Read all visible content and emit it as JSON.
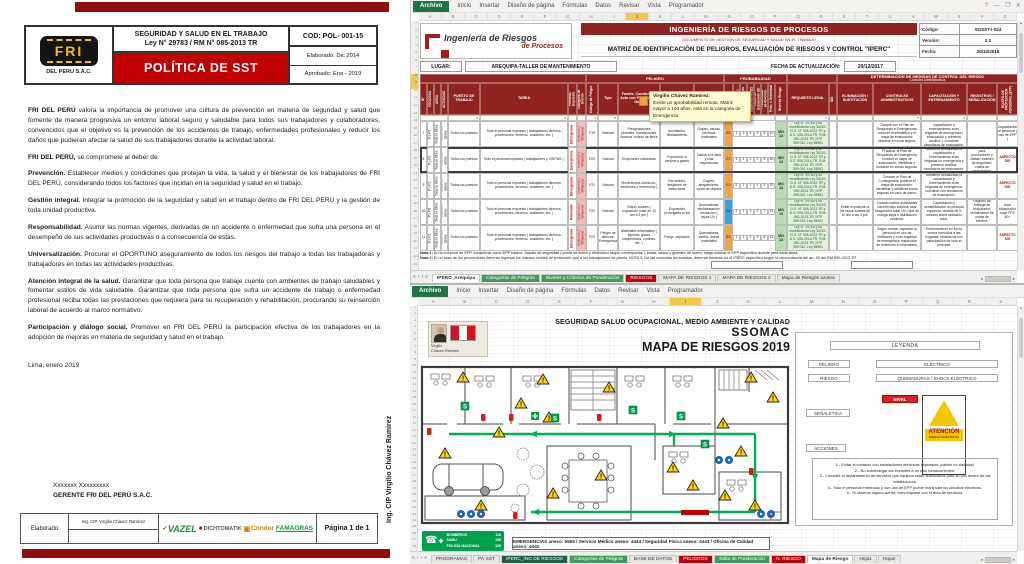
{
  "ui": {
    "ribbon_tabs": [
      "Inicio",
      "Insertar",
      "Diseño de página",
      "Fórmulas",
      "Datos",
      "Revisar",
      "Vista",
      "Programador"
    ],
    "file_tab": "Archivo",
    "win": {
      "help": "?",
      "min": "—",
      "max": "❐",
      "close": "✕"
    },
    "filter_icon": "▾",
    "tabnav": [
      "«",
      "‹",
      "›",
      "»"
    ],
    "scroll_left": "◂",
    "scroll_right": "▸",
    "scroll_up": "▴",
    "scroll_down": "▾"
  },
  "document": {
    "logo": {
      "brand": "FRI",
      "sub": "DEL PERU S.A.C."
    },
    "header": {
      "title_line1": "SEGURIDAD Y SALUD EN EL TRABAJO",
      "title_line2": "Ley N° 29783 / RM N° 085-2013 TR",
      "code": "COD: POL- 001-15",
      "policy_title": "POLÍTICA DE SST",
      "elaborated": "Elaborado:  Dic 2014",
      "approved": "Aprobado: Ene - 2019"
    },
    "paragraphs": [
      {
        "lead": "FRI DEL PERÚ",
        "text": " valora  la importancia de promover una cultura de prevención  en materia de seguridad y salud que fomente de manera progresiva un entorno  laboral seguro y saludable para todos sus trabajadores y colaboradores, convencidos que el objetivo es  la prevención de los accidentes de trabajo, enfermedades profesionales y reducir los daños  que  pudieran afectar  la salud de sus trabajadores durante  la actividad laboral."
      },
      {
        "lead": "FRI DEL PERÚ,",
        "text": " se compromete al deber de:"
      },
      {
        "lead": "Prevención.",
        "text": " Establecer medios y condiciones que protejan la vida, la salud y el bienestar de los trabajadores de FRI DEL PERÚ, considerando todos los factores que incidan en la seguridad  y salud en el trabajo."
      },
      {
        "lead": "Gestión integral.",
        "text": " Integrar la promoción de la seguridad y salud en el trabajo dentro de FRI DEL PERÚ y la gestión  de toda unidad productiva."
      },
      {
        "lead": "Responsabilidad.",
        "text": " Asumir las  normas vigentes, derivadas de un accidente o enfermedad que sufra una persona en  el desempeño de sus actividades productivas o a consecuencia de éstas."
      },
      {
        "lead": "Universalización.",
        "text": " Procurar el OPORTUNO aseguramiento de todos los riesgos del trabajo a todas las  trabajadoras y trabajadores en todas las actividades productivas."
      },
      {
        "lead": "Atención integral de la salud.",
        "text": " Garantizar que toda persona que trabaje cuente con  ambientes de trabajo saludables y fomentar estilos de vida saludable.  Garantizar que toda persona que sufra un accidente de trabajo o enfermedad profesional  reciba todas las prestaciones que requiera para su  recuperación  y  rehabilitación,  procurando   su  reinserción  laboral  de  acuerdo  al  marco normativo."
      },
      {
        "lead": "Participación y diálogo social.",
        "text": " Promover en FRI DEL PERÚ la participación  efectiva de los trabajadores en la adopción de mejoras en  materia de seguridad y salud en el trabajo."
      }
    ],
    "date": "Lima, enero 2019",
    "sign": {
      "name": "Xxxxxxx Xxxxxxxxx",
      "role": "GERENTE FRI DEL PERÚ S.A.C."
    },
    "footer": {
      "label": "Elaborado",
      "name": "Ing. CIP. Virgilio Chávez Ramírez",
      "page": "Página 1 de 1",
      "logos": [
        {
          "label": "VAZEL",
          "cls": "vazel"
        },
        {
          "label": "DICHTOMATIK",
          "cls": "dicht"
        },
        {
          "label": "Condor",
          "cls": "condor"
        },
        {
          "label": "FAMAGRAS",
          "cls": "fama"
        }
      ]
    },
    "side_note": "Ing. CIP Virgilio Chávez Ramirez"
  },
  "excel_top": {
    "brand": {
      "line1": "Ingeniería de Riesgos",
      "line2": "de Procesos"
    },
    "band": {
      "t1": "INGENIERÍA DE RIESGOS DE PROCESOS",
      "t2": "DOCUMENTO DE GESTIÓN DE SEGURIDAD Y SALUD EN EL TRABAJO",
      "t3": "MATRIZ DE IDENTIFICACIÓN DE PELIGROS, EVALUACIÓN DE RIESGOS Y CONTROL \"IPERC\""
    },
    "meta": {
      "codigo_label": "Código:",
      "codigo": "SGSST-I-024",
      "version_label": "Versión:",
      "version": "2.1",
      "fecha_label": "Fecha:",
      "fecha": "20/10/2016"
    },
    "lugar_label": "LUGAR:",
    "lugar": "AREQUIPA-TALLER DE MANTENIMIENTO",
    "factual_label": "FECHA DE ACTUALIZACIÓN:",
    "factual": "20/12/2017",
    "groups": {
      "g1": "PELIGRO",
      "g2": "PROBABILIDAD",
      "g3": "DETERMINACIÓN DE MEDIDAS DE CONTROL  DEL RIESGO",
      "g3b": "Controles Administrativos"
    },
    "columns": [
      "N°",
      "PROCESO",
      "ÁREA",
      "ACTIVIDAD",
      "PUESTO DE TRABAJO",
      "TAREA",
      "Personal Expuesto",
      "Categoría de Evento",
      "Código de Peligro",
      "Tipo",
      "Fuente, Condición o Acto con Potencial de Daño",
      "RIESGO",
      "CONSECUENCIA",
      "Severidad",
      "Índice de Personas (A)",
      "Índice de Procedimientos (B)",
      "Índice de Capacitación (C)",
      "Índice de Exposición (D)",
      "Probabilidad (A+B+C+D)",
      "Prob. x Severidad",
      "Nivel de Riesgo",
      "REQUISITO LEGAL",
      "SIG",
      "ELIMINACIÓN / SUSTITUCIÓN",
      "CONTROLES ADMINISTRATIVOS",
      "CAPACITACIÓN Y ENTRENAMIENTO",
      "REGISTROS / SEÑALIZACIÓN",
      "EQUIPO DE PROTECCIÓN PERSONAL (EPP)"
    ],
    "rows": [
      {
        "n": "7",
        "c1": "P1-P2",
        "c2": "Toda la Obra",
        "c3": "Todos los dptos.",
        "puesto": "Todos los puestos",
        "tarea": "Todo el personal expuesto ( trabajadores directos, proveedores, terceros, visitantes, etc. )",
        "exp": "Emergencia",
        "cat": "Urgencia 2 Temporal",
        "cod": "F19",
        "tipo": "Natural",
        "fuente": "Precipitaciones pluviales, inundaciones, huaicos, bolsón de tierra",
        "riesgo": "Inundación, deslizamiento",
        "consec": "Golpes, caídas, pérdidas materiales",
        "sev": "E2",
        "sevcolor": "orange",
        "nums": [
          1,
          1,
          1,
          2,
          5,
          10
        ],
        "nivel": "MO 13",
        "legal": "Ley N° 29783 y su modificatoria Ley 30222, D.S. N° 005-2012-TR y D.S. 006-2014-TR, R.M. 050-2013-TR, NTP 399.010, Ley 28551",
        "sig": "",
        "elim": "",
        "ctrl": "Cumplir con el Plan de Respuesta a Emergencias; conocer la señalética y el mapa de evacuación; ubicarse en zona segura.",
        "capac": "Mantener actualizada la capacitación y entrenamiento a las brigadas de emergencia ( evacuación y primeros auxilios ); coordinar simulacros de evacuación.",
        "reg": "",
        "epp": "Capacitación al personal ( uso de EPP )",
        "eppflag": ""
      },
      {
        "n": "8",
        "sel": "1",
        "c1": "P1-P2",
        "c2": "Toda la Obra",
        "c3": "Todos los dptos.",
        "puesto": "Todos los puestos",
        "tarea": "Todo el personal expuesto ( trabajadores y VISITAS. )",
        "exp": "Emergencia",
        "cat": "Urgencia 2 Temporal",
        "cod": "F20",
        "tipo": "Natural",
        "fuente": "Erupciones volcánicas",
        "riesgo": "Exposición a cenizas y gases",
        "consec": "Daños a la vista y vías respiratorias",
        "sev": "E2",
        "sevcolor": "orange",
        "nums": [
          1,
          1,
          1,
          2,
          5,
          10
        ],
        "nivel": "MO 13",
        "legal": "Ley N° 29783 y su modificatoria Ley 30222, D.S. N° 005-2012-TR y D.S. 006-2014-TR, R.M. 050-2013-TR, NTP 399.010, Ley 28551",
        "sig": "",
        "elim": "",
        "ctrl": "Practicar el Plan de Respuesta de Emergencia; conocer el mapa de evacuación; identificar y ubicarse en zonas seguras.",
        "capac": "Mantener actualizada la capacitación y entrenamiento a las brigadas de emergencia y primeros auxilios; simulacros de evacuación.",
        "reg": "Registro / charla para proveedores y visitas; examen de seguridad; charla de capacitación.",
        "epp": "ASPECTO SIG",
        "eppflag": "red"
      },
      {
        "n": "9",
        "c1": "P1-P2",
        "c2": "Toda la Obra",
        "c3": "Todos los dptos.",
        "puesto": "Todos los puestos",
        "tarea": "Todo el personal expuesto ( trabajadores directos, proveedores, terceros, visitantes, etc. )",
        "exp": "Emergencia",
        "cat": "Urgencia 2 Temporal",
        "cod": "F21",
        "tipo": "Natural",
        "fuente": "Movimientos sísmicos ( temblores y terremotos )",
        "riesgo": "Derrumbes, desplome de estructuras",
        "consec": "Golpes, atrapamiento, caída de objetos",
        "sev": "E2",
        "sevcolor": "orange",
        "nums": [
          2,
          1,
          1,
          1,
          5,
          10
        ],
        "nivel": "MO 13",
        "legal": "Ley N° 29783 y su modificatoria Ley 30222, D.S. N° 005-2012-TR y D.S. 006-2014-TR, R.M. 050-2013-TR, NTP 399.010, Ley 28551",
        "sig": "",
        "elim": "",
        "ctrl": "Conocer el Plan de Contingencia; publicar el mapa de evacuación; identificar y señalizar zonas seguras en caso de sismo.",
        "capac": "Mantener actualizada la capacitación y entrenamiento a las brigadas de emergencia; coordinar con simulacros de evacuación.",
        "reg": "",
        "epp": "ASPECTO SIG",
        "eppflag": "red"
      },
      {
        "n": "10",
        "c1": "P1-P2",
        "c2": "Toda la Obra",
        "c3": "Todos los dptos.",
        "puesto": "Todos los puestos",
        "tarea": "Todo el personal expuesto ( trabajadores directos, proveedores, terceros, visitantes, etc. )",
        "exp": "Relevante",
        "cat": "Urgencia 2 Temporal",
        "cod": "F22",
        "tipo": "Natural",
        "fuente": "Rayos solares ( exposición solar de 10 am a 3 pm )",
        "riesgo": "Exposición prolongada al sol",
        "consec": "Quemaduras, deshidratación, insolación ( rayos UV )",
        "sev": "S1",
        "sevcolor": "blue",
        "nums": [
          2,
          1,
          1,
          3,
          7,
          14
        ],
        "nivel": "MO 13",
        "legal": "Ley N° 29783 y su modificatoria Ley 30222, D.S. N° 005-2012-TR y D.S. 006-2014-TR, R.M. 050-2013-TR, NTP 399.010, Ley 28551",
        "sig": "",
        "elim": "Evitar exposición a los rayos solares de 10 am a las 3 pm.",
        "ctrl": "Cuando realice actividades hacerlo bajo sombra; usar bloqueador solar UV, ropa de manga larga e hidratación continua.",
        "capac": "Capacitación y sensibilización al personal expuesto; charlas de 5 minutos sobre radiación solar.",
        "reg": "Registro de entrega de bloqueador; señalización de zonas de sombra.",
        "epp": "Usar bloqueador solar FPS 50+",
        "eppflag": ""
      },
      {
        "n": "11",
        "c1": "P1-P2",
        "c2": "Toda la Obra",
        "c3": "Todos los dptos.",
        "puesto": "Todos los puestos",
        "tarea": "Todo el personal expuesto ( trabajadores directos, proveedores, terceros, visitantes, etc. )",
        "exp": "Emergencia",
        "cat": "Urgencia 2 Temporal",
        "cod": "F23",
        "tipo": "Peligro de atención Emergencia",
        "fuente": "Materiales inflamables ( líquidos, gases comprimidos, cortinas, etc. )",
        "riesgo": "Fuego, explosión",
        "consec": "Quemaduras, asfixia, daños materiales",
        "sev": "E2",
        "sevcolor": "orange",
        "nums": [
          1,
          1,
          2,
          2,
          6,
          12
        ],
        "nivel": "MO 13",
        "legal": "Ley N° 29783 y su modificatoria Ley 30222, D.S. N° 005-2012-TR y D.S. 006-2014-TR, R.M. 050-2013-TR, NTP 399.010, Ley 28551",
        "sig": "",
        "elim": "",
        "ctrl": "Según norma: capacitar al personal en uso de extintores y a las brigadas de emergencia; inspección de extintores e inflamables.",
        "capac": "Entrenamiento en lucha contra incendios a las brigadas; simulacros con participación de todo el personal.",
        "reg": "",
        "epp": "ASPECTO SIG",
        "eppflag": "red"
      }
    ],
    "comment": {
      "author": "Virgilio Chávez Ramirez:",
      "text": "Existe un aprobabilidad remota, Matriz mayor a 100 años, esta en la categoria de Emergencia"
    },
    "notes": [
      {
        "label": "Nota 1:",
        "text": " En la columna de EPP, considerar como EPP básico: Zapato de seguridad ( punta de acero y dieléctrico según corresponda ), botas, casco y guantes de cuero; luego colocar el EPP específico acorde para cada tarea."
      },
      {
        "label": "Nota 2:",
        "text": " En el caso de los proveedores deberán ingresar los mismos niveles de protección que a los trabajadores de planta. NOTA 3: De las consultas formuladas, deberán tomarse en el IPERC específico según la concordancia del art. 50 del RM 050-2013 TR."
      }
    ],
    "sheet_tabs": [
      {
        "label": "IPERC_Arequipa",
        "color": "active"
      },
      {
        "label": "Categorías de Peligros",
        "color": "green"
      },
      {
        "label": "Niveles y Criterios de Ponderación",
        "color": "green"
      },
      {
        "label": "RIESGOS",
        "color": "red"
      },
      {
        "label": "MAPA DE RIESGOS 1",
        "color": ""
      },
      {
        "label": "MAPA DE RIESGOS 2",
        "color": ""
      },
      {
        "label": "Mapa de Riesgos azotea",
        "color": ""
      }
    ],
    "col_letters": [
      "A",
      "B",
      "C",
      "D",
      "E",
      "F",
      "G",
      "H",
      "I",
      "J",
      "K",
      "L",
      "M",
      "N",
      "O",
      "P",
      "Q",
      "R",
      "S",
      "T",
      "U",
      "V",
      "W",
      "X",
      "Y",
      "Z"
    ],
    "row_numbers": [
      1,
      2,
      3,
      4,
      5,
      6,
      7,
      8,
      9,
      10,
      11,
      12,
      13,
      14,
      15,
      16,
      17,
      18,
      19,
      20,
      21,
      22,
      23,
      24,
      25,
      26,
      27,
      28,
      29,
      30,
      31,
      32,
      33
    ]
  },
  "excel_bottom": {
    "profile": {
      "l1": "Virgilio",
      "l2": "Chávez Ramirez"
    },
    "titles": {
      "t1": "SEGURIDAD SALUD OCUPACIONAL, MEDIO AMBIENTE Y CALIDAD",
      "t2": "SSOMAC",
      "t3": "MAPA DE RIESGOS  2019"
    },
    "legend": {
      "header": "LEYENDA",
      "peligro_label": "PELIGRO",
      "peligro": "ELÉCTRICO",
      "riesgo_label": "RIESGO",
      "riesgo": "QUEMADURAS / SHOCK ELECTRICO",
      "nivel": "NIVEL",
      "senal_label": "SEÑALETICA",
      "sign_title": "ATENCIÓN",
      "sign_sub": "RIESGO ELÉCTRICO",
      "acciones_label": "ACCIONES",
      "acciones": [
        "1.- Evitar el contacto con instalaciones eléctricas expuestas (cables no aislados)",
        "2.- No sobrecargar los enchufes a un solo tomacorrientes.",
        "3.- Consulte al departamento de servicios que equipos estan autorizados para su uso dentro de las instalaciones.",
        "4.- Solo el personal entrenado y con uso de EPP puede manipular los circuitos electricos.",
        "5.- Si observa alguna averia, comuniquese con el área de servicios."
      ]
    },
    "phones": [
      {
        "name": "BOMBEROS",
        "num": "116"
      },
      {
        "name": "SAMU",
        "num": "106"
      },
      {
        "name": "POLICÍA NACIONAL",
        "num": "105"
      }
    ],
    "emergency_line": "EMERGENCIAS anexo: 5555  /  Servicio Médico anexo: 4444  /  Seguridad Física anexo: 4443  /  Oficina de Calidad anexo: 4442",
    "sheet_tabs": [
      {
        "label": "PROGRAMAS",
        "color": ""
      },
      {
        "label": "PA-SST",
        "color": ""
      },
      {
        "label": "IPERC_ING DE RIESGOS",
        "color": "darkgreen"
      },
      {
        "label": "Categorías de Peligros",
        "color": "green"
      },
      {
        "label": "BASE DE DATOS",
        "color": ""
      },
      {
        "label": "PELIGROS",
        "color": "red"
      },
      {
        "label": "Tabla de Ponderación",
        "color": "green"
      },
      {
        "label": "N. RIESGO",
        "color": "red"
      },
      {
        "label": "Mapa de Riesgo",
        "color": "active"
      },
      {
        "label": "Hoja1",
        "color": ""
      },
      {
        "label": "Hoja2",
        "color": ""
      }
    ],
    "col_letters": [
      "A",
      "B",
      "C",
      "D",
      "E",
      "F",
      "G",
      "H",
      "I",
      "J",
      "K",
      "L",
      "M",
      "N",
      "O",
      "P",
      "Q",
      "R",
      "S"
    ],
    "row_numbers": [
      1,
      2,
      3,
      4,
      5,
      6,
      7,
      8,
      9,
      10,
      11,
      12,
      13,
      14,
      15,
      16,
      17,
      18,
      19,
      20,
      21,
      22,
      23,
      24,
      25,
      26,
      27,
      28,
      29,
      30,
      31,
      32,
      33,
      34,
      35,
      36,
      37,
      38
    ]
  }
}
